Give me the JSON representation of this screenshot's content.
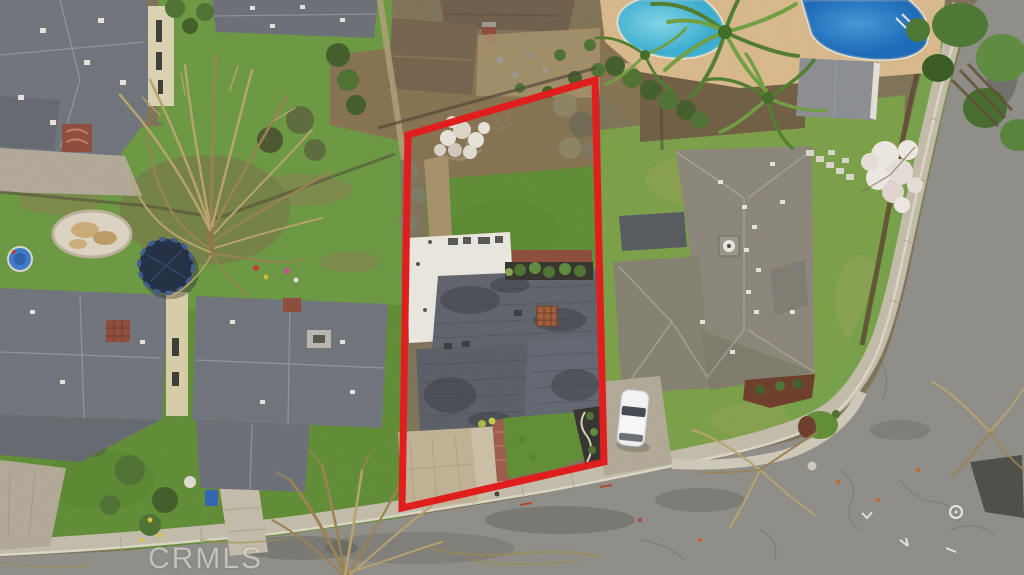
{
  "photo": {
    "watermark": "CRMLS",
    "colors": {
      "boundary_red": "#e31717",
      "lawn_green": "#5f8c33",
      "lawn_yellow_green": "#7aa046",
      "roof_gray": "#5d6169",
      "roof_gray_brown": "#8a8578",
      "roof_white": "#eae8e0",
      "roof_brown": "#6e5c48",
      "pool_light_blue": "#54c4de",
      "pool_deep_blue": "#2178c8",
      "asphalt_gray": "#8d8c86",
      "concrete_tan": "#c3bcaa",
      "car_white": "#eff0f1"
    }
  }
}
